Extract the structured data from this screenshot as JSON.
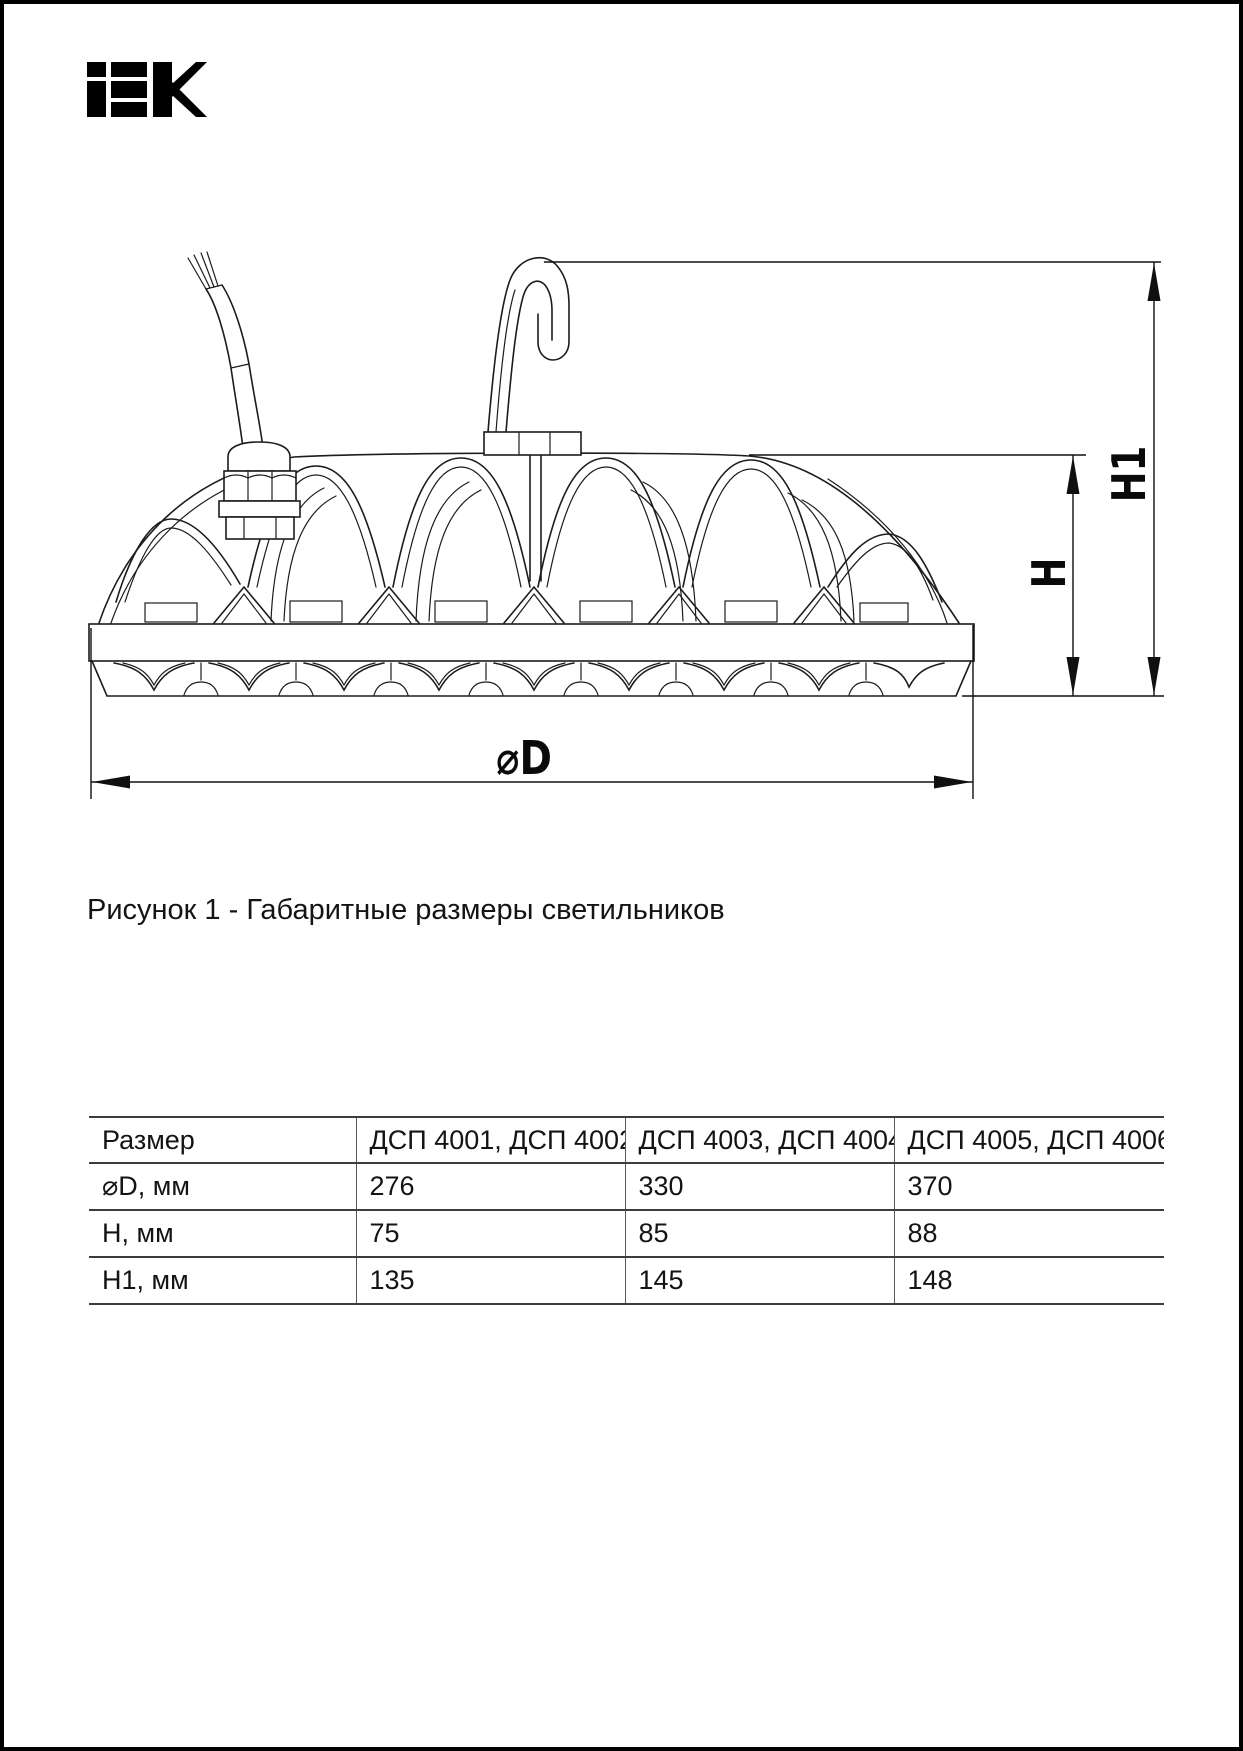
{
  "logo": {
    "alt": "IEK"
  },
  "figure": {
    "caption": "Рисунок 1 - Габаритные размеры светильников",
    "dim_labels": {
      "h1": "H1",
      "h": "H",
      "d": "⌀D"
    }
  },
  "table": {
    "columns": [
      "Размер",
      "ДСП 4001, ДСП 4002",
      "ДСП 4003, ДСП 4004",
      "ДСП 4005, ДСП 4006"
    ],
    "rows": [
      {
        "label": "⌀D, мм",
        "values": [
          "276",
          "330",
          "370"
        ]
      },
      {
        "label": "H, мм",
        "values": [
          "75",
          "85",
          "88"
        ]
      },
      {
        "label": "H1, мм",
        "values": [
          "135",
          "145",
          "148"
        ]
      }
    ]
  }
}
